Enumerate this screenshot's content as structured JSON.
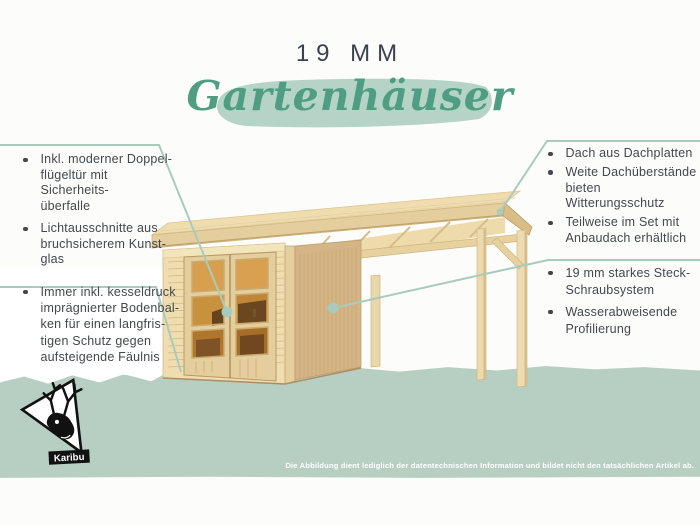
{
  "header": {
    "size_label": "19 MM",
    "title": "Gartenhäuser"
  },
  "features": {
    "left_top": {
      "items": [
        {
          "lines": [
            "Inkl. moderner Doppel-",
            "flügeltür mit Sicherheits-",
            "überfalle"
          ]
        },
        {
          "lines": [
            "Lichtausschnitte aus",
            "bruchsicherem Kunst-",
            "glas"
          ]
        }
      ]
    },
    "left_bottom": {
      "items": [
        {
          "lines": [
            "Immer inkl. kesseldruck",
            "imprägnierter Bodenbal-",
            "ken für einen langfris-",
            "tigen Schutz gegen",
            "aufsteigende Fäulnis"
          ]
        }
      ]
    },
    "right_top": {
      "items": [
        {
          "lines": [
            "Dach aus Dachplatten"
          ]
        },
        {
          "lines": [
            "Weite Dachüberstände",
            "bieten Witterungsschutz"
          ]
        },
        {
          "lines": [
            "Teilweise im Set mit",
            "Anbaudach erhältlich"
          ]
        }
      ]
    },
    "right_bottom": {
      "items": [
        {
          "lines": [
            "19 mm starkes Steck-",
            "Schraubsystem"
          ]
        },
        {
          "lines": [
            "Wasserabweisende",
            "Profilierung"
          ]
        }
      ]
    }
  },
  "footer": {
    "disclaimer": "Die Abbildung dient lediglich der datentechnischen Information und bildet nicht den tatsächlichen Artikel ab."
  },
  "logo": {
    "brand": "Karibu",
    "icon": "deer-icon"
  },
  "colors": {
    "accent_green": "#4f9e84",
    "brush_green": "#b5d3c6",
    "ground_green": "#b7cfc2",
    "line_green": "#a9cbbd",
    "ink": "#43484d",
    "heading": "#3a4150",
    "wood_light": "#efddb0",
    "wood_mid": "#e4ce9d",
    "wood_dark": "#d5b585",
    "wood_line": "#c8ab77",
    "glass_amber": "#c8913d",
    "glass_dark": "#553719"
  }
}
